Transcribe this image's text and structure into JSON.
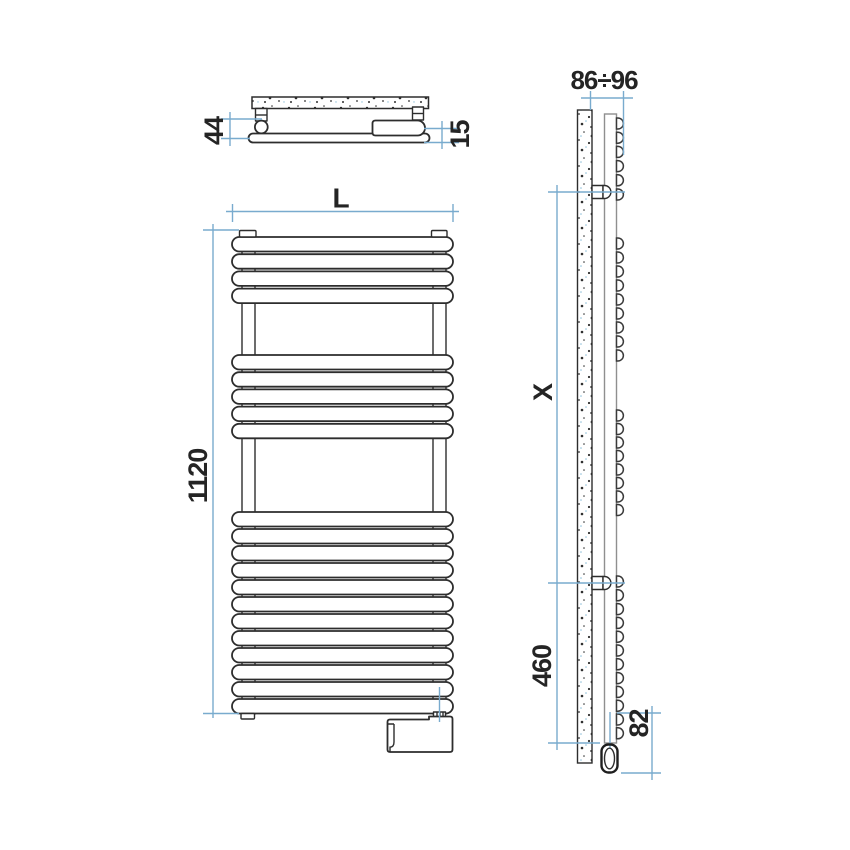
{
  "drawing": {
    "subject": "towel-radiator-technical-drawing",
    "background": "#ffffff",
    "line_color": "#2d2d2d",
    "dimension_color": "#79abce",
    "text_color": "#242424",
    "top_view": {
      "depth_label": "44",
      "profile_label": "15"
    },
    "front_view": {
      "width_label": "L",
      "height_label": "1120",
      "bars": {
        "groups": [
          4,
          5,
          12
        ],
        "group_tops": [
          237,
          355,
          512
        ],
        "pitch": 17.2,
        "pitch_last": 17.0,
        "bar_height": 14.5
      }
    },
    "side_view": {
      "wall_distance_label": "86÷96",
      "bracket_span_label": "X",
      "lower_span_label": "460",
      "element_offset_label": "82",
      "bar_ends": {
        "groups": [
          6,
          9,
          8,
          12
        ],
        "group_tops": [
          118,
          238,
          410,
          576
        ],
        "pitches": [
          14.2,
          14.0,
          13.5,
          13.8
        ],
        "end_height": 11
      }
    }
  }
}
